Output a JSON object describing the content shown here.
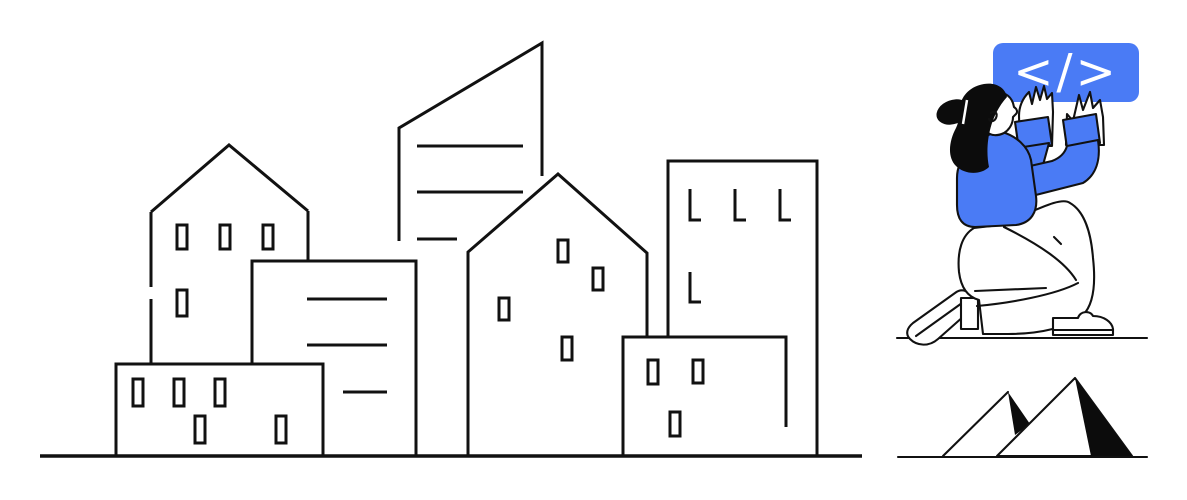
{
  "illustration": {
    "code_sign": {
      "text": "</>",
      "background": "#4a7bf5",
      "text_color": "#ffffff"
    },
    "palette": {
      "ink": "#111111",
      "accent": "#4a7bf5",
      "paper": "#ffffff",
      "solid_black": "#0c0c0c"
    }
  }
}
